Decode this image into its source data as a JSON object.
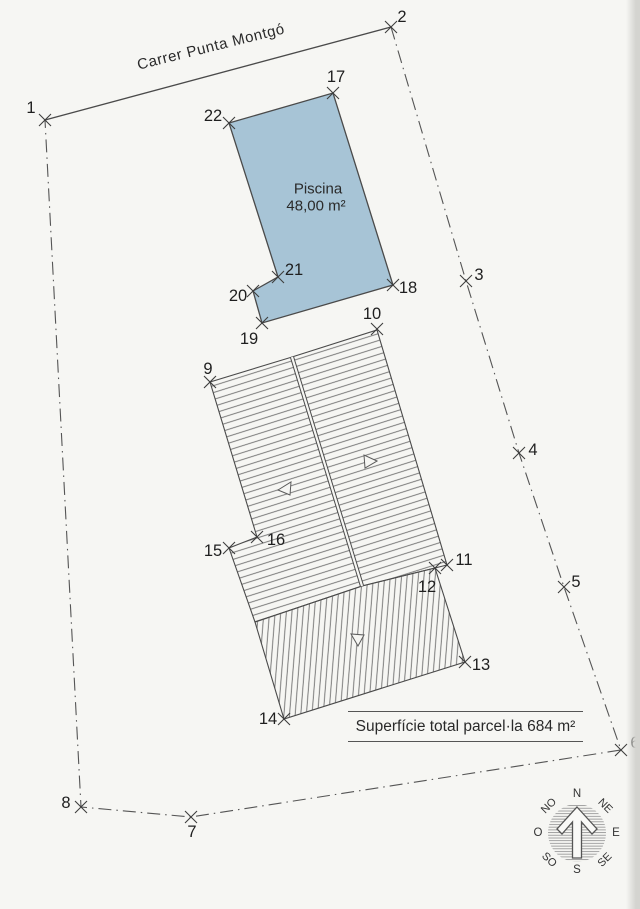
{
  "street": {
    "name": "Carrer Punta Montgó"
  },
  "pool": {
    "name": "Piscina",
    "area": "48,00 m²",
    "fill": "#a7c4d6",
    "outline": [
      [
        229,
        123
      ],
      [
        333,
        93
      ],
      [
        393,
        285
      ],
      [
        262,
        323
      ],
      [
        253,
        291
      ],
      [
        278,
        277
      ]
    ]
  },
  "parcel": {
    "total_label": "Superfície total parcel·la  684 m²",
    "street_edge": [
      [
        45,
        120
      ],
      [
        391,
        27
      ]
    ],
    "boundary": [
      [
        391,
        27
      ],
      [
        466,
        281
      ],
      [
        519,
        453
      ],
      [
        564,
        587
      ],
      [
        621,
        750
      ],
      [
        191,
        817
      ],
      [
        81,
        807
      ],
      [
        45,
        120
      ]
    ]
  },
  "building": {
    "roof_left_slope": [
      [
        210,
        382
      ],
      [
        292,
        357
      ],
      [
        362,
        586
      ],
      [
        255,
        622
      ],
      [
        229,
        548
      ],
      [
        257,
        537
      ]
    ],
    "roof_right_slope": [
      [
        292,
        357
      ],
      [
        377,
        330
      ],
      [
        447,
        565
      ],
      [
        362,
        586
      ]
    ],
    "porch_roof": [
      [
        255,
        622
      ],
      [
        362,
        586
      ],
      [
        435,
        568
      ],
      [
        465,
        662
      ],
      [
        284,
        719
      ]
    ],
    "ridge": [
      [
        292,
        357
      ],
      [
        362,
        586
      ]
    ],
    "slope_arrows": [
      {
        "points": [
          [
            278,
            490
          ],
          [
            291,
            482
          ],
          [
            290,
            495
          ]
        ]
      },
      {
        "points": [
          [
            377,
            461
          ],
          [
            364,
            455
          ],
          [
            365,
            468
          ]
        ]
      },
      {
        "points": [
          [
            358,
            646
          ],
          [
            351,
            634
          ],
          [
            364,
            635
          ]
        ]
      }
    ]
  },
  "survey_points": [
    {
      "n": "1",
      "x": 45,
      "y": 120,
      "lx": 31,
      "ly": 108
    },
    {
      "n": "2",
      "x": 391,
      "y": 27,
      "lx": 402,
      "ly": 17
    },
    {
      "n": "3",
      "x": 466,
      "y": 281,
      "lx": 479,
      "ly": 275
    },
    {
      "n": "4",
      "x": 519,
      "y": 453,
      "lx": 533,
      "ly": 450
    },
    {
      "n": "5",
      "x": 564,
      "y": 587,
      "lx": 576,
      "ly": 582
    },
    {
      "n": "6",
      "x": 621,
      "y": 750,
      "lx": 635,
      "ly": 743
    },
    {
      "n": "7",
      "x": 191,
      "y": 817,
      "lx": 192,
      "ly": 832
    },
    {
      "n": "8",
      "x": 81,
      "y": 807,
      "lx": 66,
      "ly": 803
    },
    {
      "n": "9",
      "x": 210,
      "y": 382,
      "lx": 208,
      "ly": 369
    },
    {
      "n": "10",
      "x": 377,
      "y": 329,
      "lx": 372,
      "ly": 314
    },
    {
      "n": "11",
      "x": 447,
      "y": 565,
      "lx": 464,
      "ly": 560
    },
    {
      "n": "12",
      "x": 435,
      "y": 568,
      "lx": 427,
      "ly": 587
    },
    {
      "n": "13",
      "x": 465,
      "y": 662,
      "lx": 481,
      "ly": 665
    },
    {
      "n": "14",
      "x": 284,
      "y": 719,
      "lx": 268,
      "ly": 719
    },
    {
      "n": "15",
      "x": 229,
      "y": 548,
      "lx": 213,
      "ly": 551
    },
    {
      "n": "16",
      "x": 257,
      "y": 537,
      "lx": 276,
      "ly": 540
    },
    {
      "n": "17",
      "x": 333,
      "y": 93,
      "lx": 336,
      "ly": 77
    },
    {
      "n": "18",
      "x": 393,
      "y": 285,
      "lx": 408,
      "ly": 288
    },
    {
      "n": "19",
      "x": 262,
      "y": 323,
      "lx": 249,
      "ly": 339
    },
    {
      "n": "20",
      "x": 253,
      "y": 291,
      "lx": 238,
      "ly": 296
    },
    {
      "n": "21",
      "x": 278,
      "y": 277,
      "lx": 294,
      "ly": 270
    },
    {
      "n": "22",
      "x": 229,
      "y": 123,
      "lx": 213,
      "ly": 116
    }
  ],
  "compass": {
    "cx": 577,
    "cy": 833,
    "r": 29,
    "labels": [
      {
        "t": "N",
        "dx": 0,
        "dy": -39,
        "rot": 0
      },
      {
        "t": "NE",
        "dx": 28,
        "dy": -27,
        "rot": 45
      },
      {
        "t": "E",
        "dx": 39,
        "dy": 0,
        "rot": 0
      },
      {
        "t": "SE",
        "dx": 28,
        "dy": 27,
        "rot": -45
      },
      {
        "t": "S",
        "dx": 0,
        "dy": 37,
        "rot": 0
      },
      {
        "t": "SO",
        "dx": -28,
        "dy": 27,
        "rot": 45
      },
      {
        "t": "O",
        "dx": -39,
        "dy": 0,
        "rot": 0
      },
      {
        "t": "NO",
        "dx": -28,
        "dy": -27,
        "rot": -45
      }
    ]
  },
  "colors": {
    "paper": "#f6f6f3",
    "line": "#4a4a4a",
    "boundary": "#555555",
    "hatch": "#6e6e6e",
    "text": "#1f1f1f",
    "pool_fill": "#a7c4d6"
  }
}
